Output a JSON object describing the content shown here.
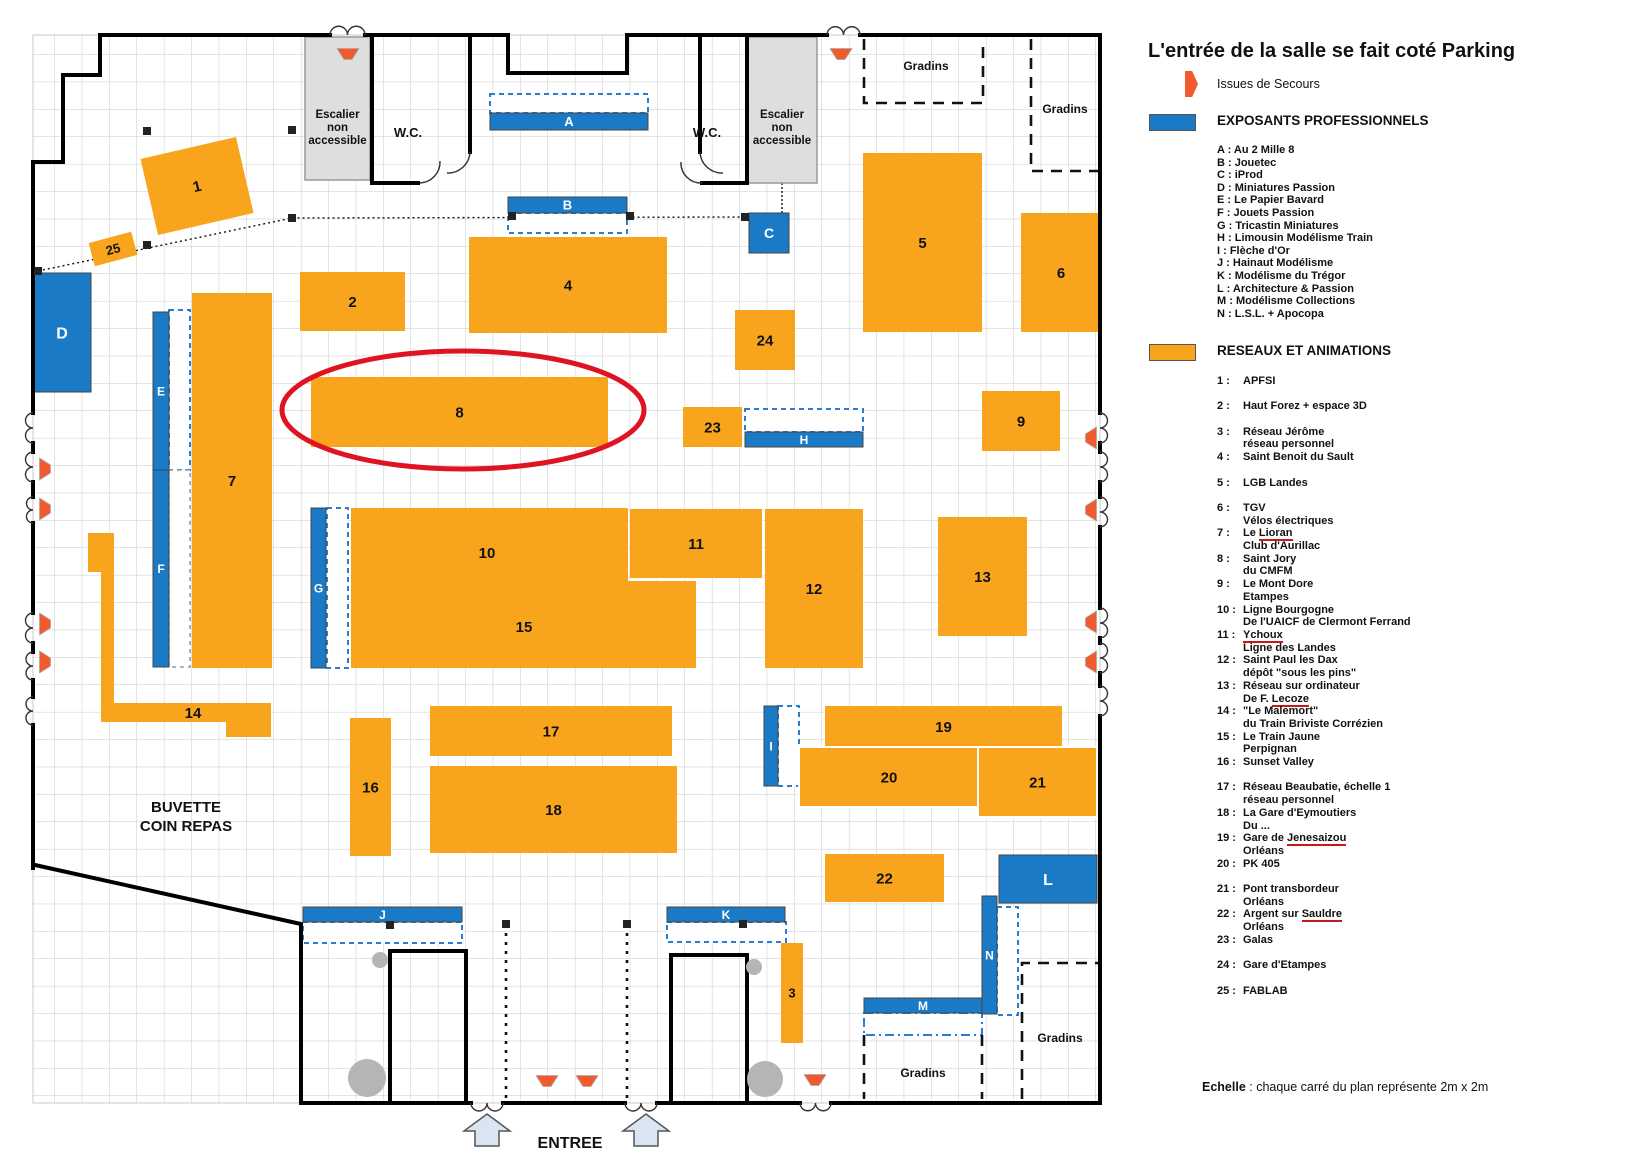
{
  "colors": {
    "booth_orange": "#F8A51D",
    "booth_blue": "#1B7AC6",
    "exit_icon": "#F05A2D",
    "highlight_red": "#DE1423",
    "room_gray": "#DEDEDE",
    "grid_line": "#C9C9C9"
  },
  "legend": {
    "title": "L'entrée de la salle se fait coté Parking",
    "issues_label": "Issues de Secours",
    "pro_header": "EXPOSANTS PROFESSIONNELS",
    "net_header": "RESEAUX ET ANIMATIONS",
    "exhibitors": [
      {
        "code": "A",
        "name": "Au 2 Mille 8"
      },
      {
        "code": "B",
        "name": "Jouetec"
      },
      {
        "code": "C",
        "name": "iProd"
      },
      {
        "code": "D",
        "name": "Miniatures Passion"
      },
      {
        "code": "E",
        "name": "Le Papier Bavard"
      },
      {
        "code": "F",
        "name": "Jouets Passion"
      },
      {
        "code": "G",
        "name": "Tricastin Miniatures"
      },
      {
        "code": "H",
        "name": "Limousin Modélisme Train"
      },
      {
        "code": "I",
        "name": "Flèche d'Or"
      },
      {
        "code": "J",
        "name": "Hainaut Modélisme"
      },
      {
        "code": "K",
        "name": "Modélisme du Trégor"
      },
      {
        "code": "L",
        "name": "Architecture & Passion"
      },
      {
        "code": "M",
        "name": "Modélisme Collections"
      },
      {
        "code": "N",
        "name": "L.S.L. + Apocopa"
      }
    ],
    "networks": [
      {
        "num": "1",
        "gap": false,
        "lines": [
          [
            {
              "t": "APFSI"
            }
          ]
        ]
      },
      {
        "num": "2",
        "gap": true,
        "lines": [
          [
            {
              "t": "Haut Forez + espace 3D"
            }
          ]
        ]
      },
      {
        "num": "3",
        "gap": true,
        "lines": [
          [
            {
              "t": "Réseau Jérôme"
            }
          ],
          [
            {
              "t": "réseau personnel"
            }
          ]
        ]
      },
      {
        "num": "4",
        "gap": false,
        "lines": [
          [
            {
              "t": "Saint Benoit du Sault"
            }
          ]
        ]
      },
      {
        "num": "5",
        "gap": true,
        "lines": [
          [
            {
              "t": "LGB Landes"
            }
          ]
        ]
      },
      {
        "num": "6",
        "gap": true,
        "lines": [
          [
            {
              "t": "TGV"
            }
          ],
          [
            {
              "t": "Vélos  électriques"
            }
          ]
        ]
      },
      {
        "num": "7",
        "gap": false,
        "lines": [
          [
            {
              "t": "Le "
            },
            {
              "t": "Lioran",
              "u": true
            }
          ],
          [
            {
              "t": "Club d'Aurillac"
            }
          ]
        ]
      },
      {
        "num": "8",
        "gap": false,
        "lines": [
          [
            {
              "t": "Saint Jory"
            }
          ],
          [
            {
              "t": "du CMFM"
            }
          ]
        ]
      },
      {
        "num": "9",
        "gap": false,
        "lines": [
          [
            {
              "t": "Le Mont Dore"
            }
          ],
          [
            {
              "t": "Etampes"
            }
          ]
        ]
      },
      {
        "num": "10",
        "gap": false,
        "lines": [
          [
            {
              "t": "Ligne Bourgogne"
            }
          ],
          [
            {
              "t": "De l'UAICF de Clermont Ferrand"
            }
          ]
        ]
      },
      {
        "num": "11",
        "gap": false,
        "lines": [
          [
            {
              "t": "Ychoux",
              "u": true
            }
          ],
          [
            {
              "t": "Ligne des Landes"
            }
          ]
        ]
      },
      {
        "num": "12",
        "gap": false,
        "lines": [
          [
            {
              "t": "Saint Paul les Dax"
            }
          ],
          [
            {
              "t": "dépôt \"sous les pins\""
            }
          ]
        ]
      },
      {
        "num": "13",
        "gap": false,
        "lines": [
          [
            {
              "t": "Réseau sur ordinateur"
            }
          ],
          [
            {
              "t": "De F. "
            },
            {
              "t": "Lecoze",
              "u": true
            }
          ]
        ]
      },
      {
        "num": "14",
        "gap": false,
        "lines": [
          [
            {
              "t": "\"Le Malemort\""
            }
          ],
          [
            {
              "t": "du Train Briviste Corrézien"
            }
          ]
        ]
      },
      {
        "num": "15",
        "gap": false,
        "lines": [
          [
            {
              "t": "Le Train Jaune"
            }
          ],
          [
            {
              "t": "Perpignan"
            }
          ]
        ]
      },
      {
        "num": "16",
        "gap": false,
        "lines": [
          [
            {
              "t": "Sunset Valley"
            }
          ]
        ]
      },
      {
        "num": "17",
        "gap": true,
        "lines": [
          [
            {
              "t": "Réseau Beaubatie, échelle 1"
            }
          ],
          [
            {
              "t": "réseau personnel"
            }
          ]
        ]
      },
      {
        "num": "18",
        "gap": false,
        "lines": [
          [
            {
              "t": "La Gare d'Eymoutiers"
            }
          ],
          [
            {
              "t": "Du ..."
            }
          ]
        ]
      },
      {
        "num": "19",
        "gap": false,
        "lines": [
          [
            {
              "t": "Gare de "
            },
            {
              "t": "Jenesaizou",
              "u": true
            }
          ],
          [
            {
              "t": "Orléans"
            }
          ]
        ]
      },
      {
        "num": "20",
        "gap": false,
        "lines": [
          [
            {
              "t": "PK 405"
            }
          ]
        ]
      },
      {
        "num": "21",
        "gap": true,
        "lines": [
          [
            {
              "t": "Pont transbordeur"
            }
          ],
          [
            {
              "t": "Orléans"
            }
          ]
        ]
      },
      {
        "num": "22",
        "gap": false,
        "lines": [
          [
            {
              "t": "Argent sur "
            },
            {
              "t": "Sauldre",
              "u": true
            }
          ],
          [
            {
              "t": "Orléans"
            }
          ]
        ]
      },
      {
        "num": "23",
        "gap": false,
        "lines": [
          [
            {
              "t": "Galas"
            }
          ]
        ]
      },
      {
        "num": "24",
        "gap": true,
        "lines": [
          [
            {
              "t": "Gare d'Etampes"
            }
          ]
        ]
      },
      {
        "num": "25",
        "gap": true,
        "lines": [
          [
            {
              "t": "FABLAB"
            }
          ]
        ]
      }
    ],
    "echelle_bold": "Echelle",
    "echelle_rest": " : chaque carré du plan représente 2m x 2m"
  },
  "plan": {
    "booths_net": [
      {
        "label": "1",
        "x": 148,
        "y": 147,
        "w": 98,
        "h": 78,
        "rot": -13
      },
      {
        "label": "25",
        "x": 91,
        "y": 237,
        "w": 44,
        "h": 24,
        "rot": -15,
        "fs": 13
      },
      {
        "label": "2",
        "x": 300,
        "y": 272,
        "w": 105,
        "h": 59
      },
      {
        "label": "4",
        "x": 469,
        "y": 237,
        "w": 198,
        "h": 96
      },
      {
        "label": "24",
        "x": 735,
        "y": 310,
        "w": 60,
        "h": 60
      },
      {
        "label": "5",
        "x": 863,
        "y": 153,
        "w": 119,
        "h": 179
      },
      {
        "label": "6",
        "x": 1021,
        "y": 213,
        "w": 80,
        "h": 119
      },
      {
        "label": "7",
        "x": 192,
        "y": 293,
        "w": 80,
        "h": 375
      },
      {
        "label": "8",
        "x": 311,
        "y": 377,
        "w": 297,
        "h": 70
      },
      {
        "label": "23",
        "x": 683,
        "y": 407,
        "w": 59,
        "h": 40
      },
      {
        "label": "9",
        "x": 982,
        "y": 391,
        "w": 78,
        "h": 60
      },
      {
        "label": "",
        "poly": "351,508 628,508 628,581 696,581 696,668 351,668"
      },
      {
        "label": "11",
        "x": 630,
        "y": 509,
        "w": 132,
        "h": 69
      },
      {
        "label": "12",
        "x": 765,
        "y": 509,
        "w": 98,
        "h": 159
      },
      {
        "label": "13",
        "x": 938,
        "y": 517,
        "w": 89,
        "h": 119
      },
      {
        "label": "16",
        "x": 350,
        "y": 718,
        "w": 41,
        "h": 138
      },
      {
        "label": "17",
        "x": 430,
        "y": 706,
        "w": 242,
        "h": 50
      },
      {
        "label": "18",
        "x": 430,
        "y": 766,
        "w": 247,
        "h": 87
      },
      {
        "label": "",
        "path": "M88,533 L114,533 L114,703 L271,703 L271,737 L226,737 L226,722 L101,722 L101,572 L88,572 Z"
      },
      {
        "label": "19",
        "x": 825,
        "y": 706,
        "w": 237,
        "h": 41
      },
      {
        "label": "20",
        "x": 799,
        "y": 747,
        "w": 180,
        "h": 60,
        "stroke": "#fff"
      },
      {
        "label": "21",
        "x": 978,
        "y": 747,
        "w": 119,
        "h": 70,
        "stroke": "#fff"
      },
      {
        "label": "22",
        "x": 825,
        "y": 854,
        "w": 119,
        "h": 48
      },
      {
        "label": "3",
        "x": 781,
        "y": 943,
        "w": 22,
        "h": 100,
        "fs": 13
      }
    ],
    "booths_pro": [
      {
        "label": "D",
        "x": 33,
        "y": 273,
        "w": 58,
        "h": 119,
        "fs": 16
      },
      {
        "label": "A",
        "x": 490,
        "y": 113,
        "w": 158,
        "h": 17,
        "fs": 13
      },
      {
        "label": "B",
        "x": 508,
        "y": 197,
        "w": 119,
        "h": 16,
        "fs": 13
      },
      {
        "label": "C",
        "x": 749,
        "y": 213,
        "w": 40,
        "h": 40,
        "fs": 14
      },
      {
        "label": "E",
        "x": 153,
        "y": 312,
        "w": 16,
        "h": 158,
        "fs": 12
      },
      {
        "label": "F",
        "x": 153,
        "y": 470,
        "w": 16,
        "h": 197,
        "fs": 12
      },
      {
        "label": "G",
        "x": 311,
        "y": 508,
        "w": 15,
        "h": 160,
        "fs": 12
      },
      {
        "label": "H",
        "x": 745,
        "y": 432,
        "w": 118,
        "h": 15,
        "fs": 12
      },
      {
        "label": "I",
        "x": 764,
        "y": 706,
        "w": 14,
        "h": 80,
        "fs": 12
      },
      {
        "label": "J",
        "x": 303,
        "y": 907,
        "w": 159,
        "h": 15,
        "fs": 12
      },
      {
        "label": "K",
        "x": 667,
        "y": 907,
        "w": 118,
        "h": 15,
        "fs": 12
      },
      {
        "label": "L",
        "x": 999,
        "y": 855,
        "w": 98,
        "h": 48,
        "fs": 16
      },
      {
        "label": "M",
        "x": 864,
        "y": 998,
        "w": 118,
        "h": 15,
        "fs": 12
      },
      {
        "label": "N",
        "x": 982,
        "y": 896,
        "w": 15,
        "h": 118,
        "fs": 12
      }
    ],
    "dash_boxes": [
      {
        "x": 490,
        "y": 94,
        "w": 158,
        "h": 19,
        "style": "blue"
      },
      {
        "x": 508,
        "y": 213,
        "w": 119,
        "h": 20,
        "style": "blue"
      },
      {
        "x": 169,
        "y": 310,
        "w": 21,
        "h": 160,
        "style": "blue"
      },
      {
        "x": 169,
        "y": 470,
        "w": 21,
        "h": 197,
        "style": "gray"
      },
      {
        "x": 327,
        "y": 508,
        "w": 21,
        "h": 160,
        "style": "blue"
      },
      {
        "x": 745,
        "y": 409,
        "w": 118,
        "h": 23,
        "style": "blue"
      },
      {
        "x": 778,
        "y": 706,
        "w": 21,
        "h": 80,
        "style": "blue"
      },
      {
        "x": 303,
        "y": 922,
        "w": 159,
        "h": 21,
        "style": "blue"
      },
      {
        "x": 667,
        "y": 922,
        "w": 119,
        "h": 20,
        "style": "blue"
      },
      {
        "x": 864,
        "y": 1013,
        "w": 118,
        "h": 22,
        "style": "dashdot"
      },
      {
        "x": 997,
        "y": 907,
        "w": 21,
        "h": 108,
        "style": "blue"
      }
    ],
    "gray_rooms": [
      {
        "x": 305,
        "y": 37,
        "w": 65,
        "h": 143,
        "lines": [
          "Escalier",
          "non",
          "accessible"
        ]
      },
      {
        "x": 747,
        "y": 37,
        "w": 70,
        "h": 146,
        "lines": [
          "Escalier",
          "non",
          "accessible"
        ]
      }
    ],
    "texts": [
      {
        "t": "W.C.",
        "x": 408,
        "y": 137,
        "fs": 13
      },
      {
        "t": "W.C.",
        "x": 707,
        "y": 137,
        "fs": 13
      },
      {
        "t": "10",
        "x": 487,
        "y": 558,
        "fs": 15
      },
      {
        "t": "15",
        "x": 524,
        "y": 632,
        "fs": 15
      },
      {
        "t": "14",
        "x": 193,
        "y": 718,
        "fs": 15
      },
      {
        "t": "Gradins",
        "x": 926,
        "y": 70,
        "fs": 12
      },
      {
        "t": "Gradins",
        "x": 1065,
        "y": 113,
        "fs": 12
      },
      {
        "t": "Gradins",
        "x": 923,
        "y": 1077,
        "fs": 12
      },
      {
        "t": "Gradins",
        "x": 1060,
        "y": 1042,
        "fs": 12
      },
      {
        "t": "BUVETTE",
        "x": 186,
        "y": 812,
        "fs": 15
      },
      {
        "t": "COIN REPAS",
        "x": 186,
        "y": 831,
        "fs": 15
      },
      {
        "t": "ENTREE",
        "x": 570,
        "y": 1148,
        "fs": 16
      }
    ],
    "exit_icons": [
      {
        "cx": 348,
        "cy": 54,
        "rot": 0
      },
      {
        "cx": 841,
        "cy": 54,
        "rot": 0
      },
      {
        "cx": 45,
        "cy": 469,
        "rot": -90
      },
      {
        "cx": 45,
        "cy": 509,
        "rot": -90
      },
      {
        "cx": 45,
        "cy": 624,
        "rot": -90
      },
      {
        "cx": 45,
        "cy": 662,
        "rot": -90
      },
      {
        "cx": 1091,
        "cy": 438,
        "rot": 90
      },
      {
        "cx": 1091,
        "cy": 510,
        "rot": 90
      },
      {
        "cx": 1091,
        "cy": 622,
        "rot": 90
      },
      {
        "cx": 1091,
        "cy": 662,
        "rot": 90
      },
      {
        "cx": 547,
        "cy": 1081,
        "rot": 0
      },
      {
        "cx": 587,
        "cy": 1081,
        "rot": 0
      },
      {
        "cx": 815,
        "cy": 1080,
        "rot": 0
      }
    ],
    "pillars": [
      [
        147,
        131
      ],
      [
        292,
        130
      ],
      [
        38,
        271
      ],
      [
        147,
        245
      ],
      [
        292,
        218
      ],
      [
        512,
        216
      ],
      [
        630,
        216
      ],
      [
        745,
        217
      ],
      [
        390,
        925
      ],
      [
        506,
        924
      ],
      [
        627,
        924
      ],
      [
        743,
        924
      ]
    ],
    "circles": [
      {
        "cx": 380,
        "cy": 960,
        "r": 8
      },
      {
        "cx": 367,
        "cy": 1078,
        "r": 19
      },
      {
        "cx": 754,
        "cy": 967,
        "r": 8
      },
      {
        "cx": 765,
        "cy": 1079,
        "r": 18
      }
    ]
  }
}
